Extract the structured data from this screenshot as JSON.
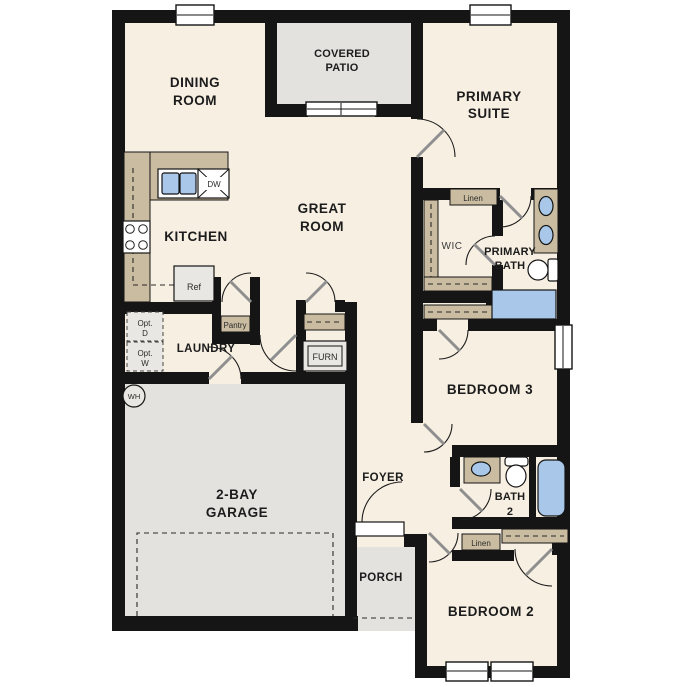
{
  "plan": {
    "title": "single-story floor plan",
    "rooms": {
      "dining": {
        "line1": "DINING",
        "line2": "ROOM"
      },
      "covered_patio": {
        "line1": "COVERED",
        "line2": "PATIO"
      },
      "primary_suite": {
        "line1": "PRIMARY",
        "line2": "SUITE"
      },
      "great_room": {
        "line1": "GREAT",
        "line2": "ROOM"
      },
      "kitchen": {
        "label": "KITCHEN"
      },
      "wic": {
        "label": "WIC"
      },
      "primary_bath": {
        "line1": "PRIMARY",
        "line2": "BATH"
      },
      "laundry": {
        "label": "LAUNDRY"
      },
      "bedroom3": {
        "label": "BEDROOM 3"
      },
      "garage": {
        "line1": "2-BAY",
        "line2": "GARAGE"
      },
      "foyer": {
        "label": "FOYER"
      },
      "bath2": {
        "line1": "BATH",
        "line2": "2"
      },
      "porch": {
        "label": "PORCH"
      },
      "bedroom2": {
        "label": "BEDROOM 2"
      }
    },
    "features": {
      "linen_upper": "Linen",
      "linen_lower": "Linen",
      "pantry": "Pantry",
      "furnace": "FURN",
      "refrigerator": "Ref",
      "dishwasher": "DW",
      "water_heater": "WH",
      "opt_dryer_line1": "Opt.",
      "opt_dryer_line2": "D",
      "opt_washer_line1": "Opt.",
      "opt_washer_line2": "W"
    },
    "colors": {
      "floor": "#f7efe2",
      "outdoor": "#e4e2df",
      "wall": "#151515",
      "cabinet": "#c9bca0",
      "fixture_blue": "#a9c8e9",
      "unit_gray": "#e9e7e3"
    }
  }
}
